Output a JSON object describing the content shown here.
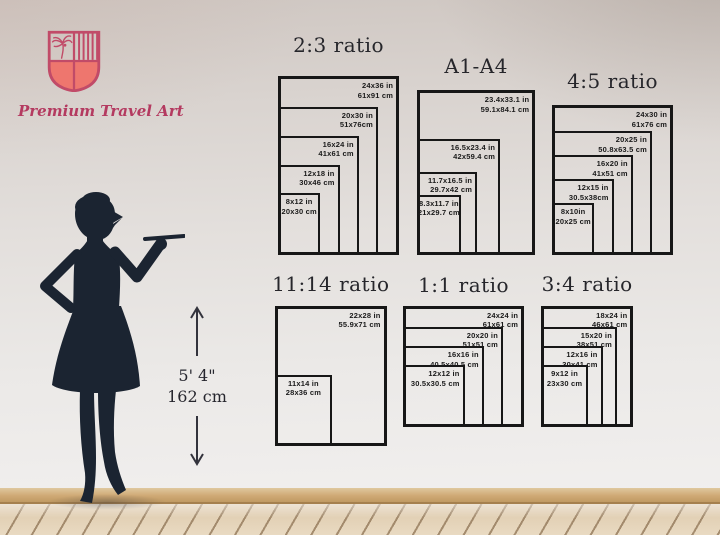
{
  "brand": {
    "name": "Premium Travel Art"
  },
  "person": {
    "height_imperial": "5' 4\"",
    "height_metric": "162 cm"
  },
  "diagrams": [
    {
      "id": "ratio-2-3",
      "title": "2:3 ratio",
      "sizes": [
        {
          "w": 24,
          "h": 36,
          "label_in": "24x36 in",
          "label_cm": "61x91 cm",
          "align": "right"
        },
        {
          "w": 20,
          "h": 30,
          "label_in": "20x30 in",
          "label_cm": "51x76cm",
          "align": "right"
        },
        {
          "w": 16,
          "h": 24,
          "label_in": "16x24 in",
          "label_cm": "41x61 cm",
          "align": "right"
        },
        {
          "w": 12,
          "h": 18,
          "label_in": "12x18 in",
          "label_cm": "30x46 cm",
          "align": "right"
        },
        {
          "w": 8,
          "h": 12,
          "label_in": "8x12 in",
          "label_cm": "20x30 cm",
          "align": "center"
        }
      ]
    },
    {
      "id": "a1-a4",
      "title": "A1-A4",
      "sizes": [
        {
          "w": 23.4,
          "h": 33.1,
          "label_in": "23.4x33.1 in",
          "label_cm": "59.1x84.1 cm",
          "align": "right"
        },
        {
          "w": 16.5,
          "h": 23.4,
          "label_in": "16.5x23.4 in",
          "label_cm": "42x59.4 cm",
          "align": "right"
        },
        {
          "w": 11.7,
          "h": 16.5,
          "label_in": "11.7x16.5 in",
          "label_cm": "29.7x42 cm",
          "align": "right"
        },
        {
          "w": 8.3,
          "h": 11.7,
          "label_in": "8.3x11.7 in",
          "label_cm": "21x29.7 cm",
          "align": "center"
        }
      ]
    },
    {
      "id": "ratio-4-5",
      "title": "4:5 ratio",
      "sizes": [
        {
          "w": 24,
          "h": 30,
          "label_in": "24x30 in",
          "label_cm": "61x76 cm",
          "align": "right"
        },
        {
          "w": 20,
          "h": 25,
          "label_in": "20x25 in",
          "label_cm": "50.8x63.5 cm",
          "align": "right"
        },
        {
          "w": 16,
          "h": 20,
          "label_in": "16x20 in",
          "label_cm": "41x51 cm",
          "align": "right"
        },
        {
          "w": 12,
          "h": 15,
          "label_in": "12x15 in",
          "label_cm": "30.5x38cm",
          "align": "right"
        },
        {
          "w": 8,
          "h": 10,
          "label_in": "8x10in",
          "label_cm": "20x25 cm",
          "align": "center"
        }
      ]
    },
    {
      "id": "ratio-11-14",
      "title": "11:14 ratio",
      "sizes": [
        {
          "w": 22,
          "h": 28,
          "label_in": "22x28 in",
          "label_cm": "55.9x71 cm",
          "align": "right"
        },
        {
          "w": 11,
          "h": 14,
          "label_in": "11x14 in",
          "label_cm": "28x36 cm",
          "align": "center"
        }
      ]
    },
    {
      "id": "ratio-1-1",
      "title": "1:1 ratio",
      "sizes": [
        {
          "w": 24,
          "h": 24,
          "label_in": "24x24 in",
          "label_cm": "61x61 cm",
          "align": "right"
        },
        {
          "w": 20,
          "h": 20,
          "label_in": "20x20 in",
          "label_cm": "51x51 cm",
          "align": "right"
        },
        {
          "w": 16,
          "h": 16,
          "label_in": "16x16 in",
          "label_cm": "40.5x40.5 cm",
          "align": "right"
        },
        {
          "w": 12,
          "h": 12,
          "label_in": "12x12 in",
          "label_cm": "30.5x30.5 cm",
          "align": "right"
        }
      ]
    },
    {
      "id": "ratio-3-4",
      "title": "3:4 ratio",
      "sizes": [
        {
          "w": 18,
          "h": 24,
          "label_in": "18x24 in",
          "label_cm": "46x61 cm",
          "align": "right"
        },
        {
          "w": 15,
          "h": 20,
          "label_in": "15x20 in",
          "label_cm": "38x51 cm",
          "align": "right"
        },
        {
          "w": 12,
          "h": 16,
          "label_in": "12x16 in",
          "label_cm": "30x41 cm",
          "align": "right"
        },
        {
          "w": 9,
          "h": 12,
          "label_in": "9x12 in",
          "label_cm": "23x30 cm",
          "align": "center"
        }
      ]
    }
  ]
}
